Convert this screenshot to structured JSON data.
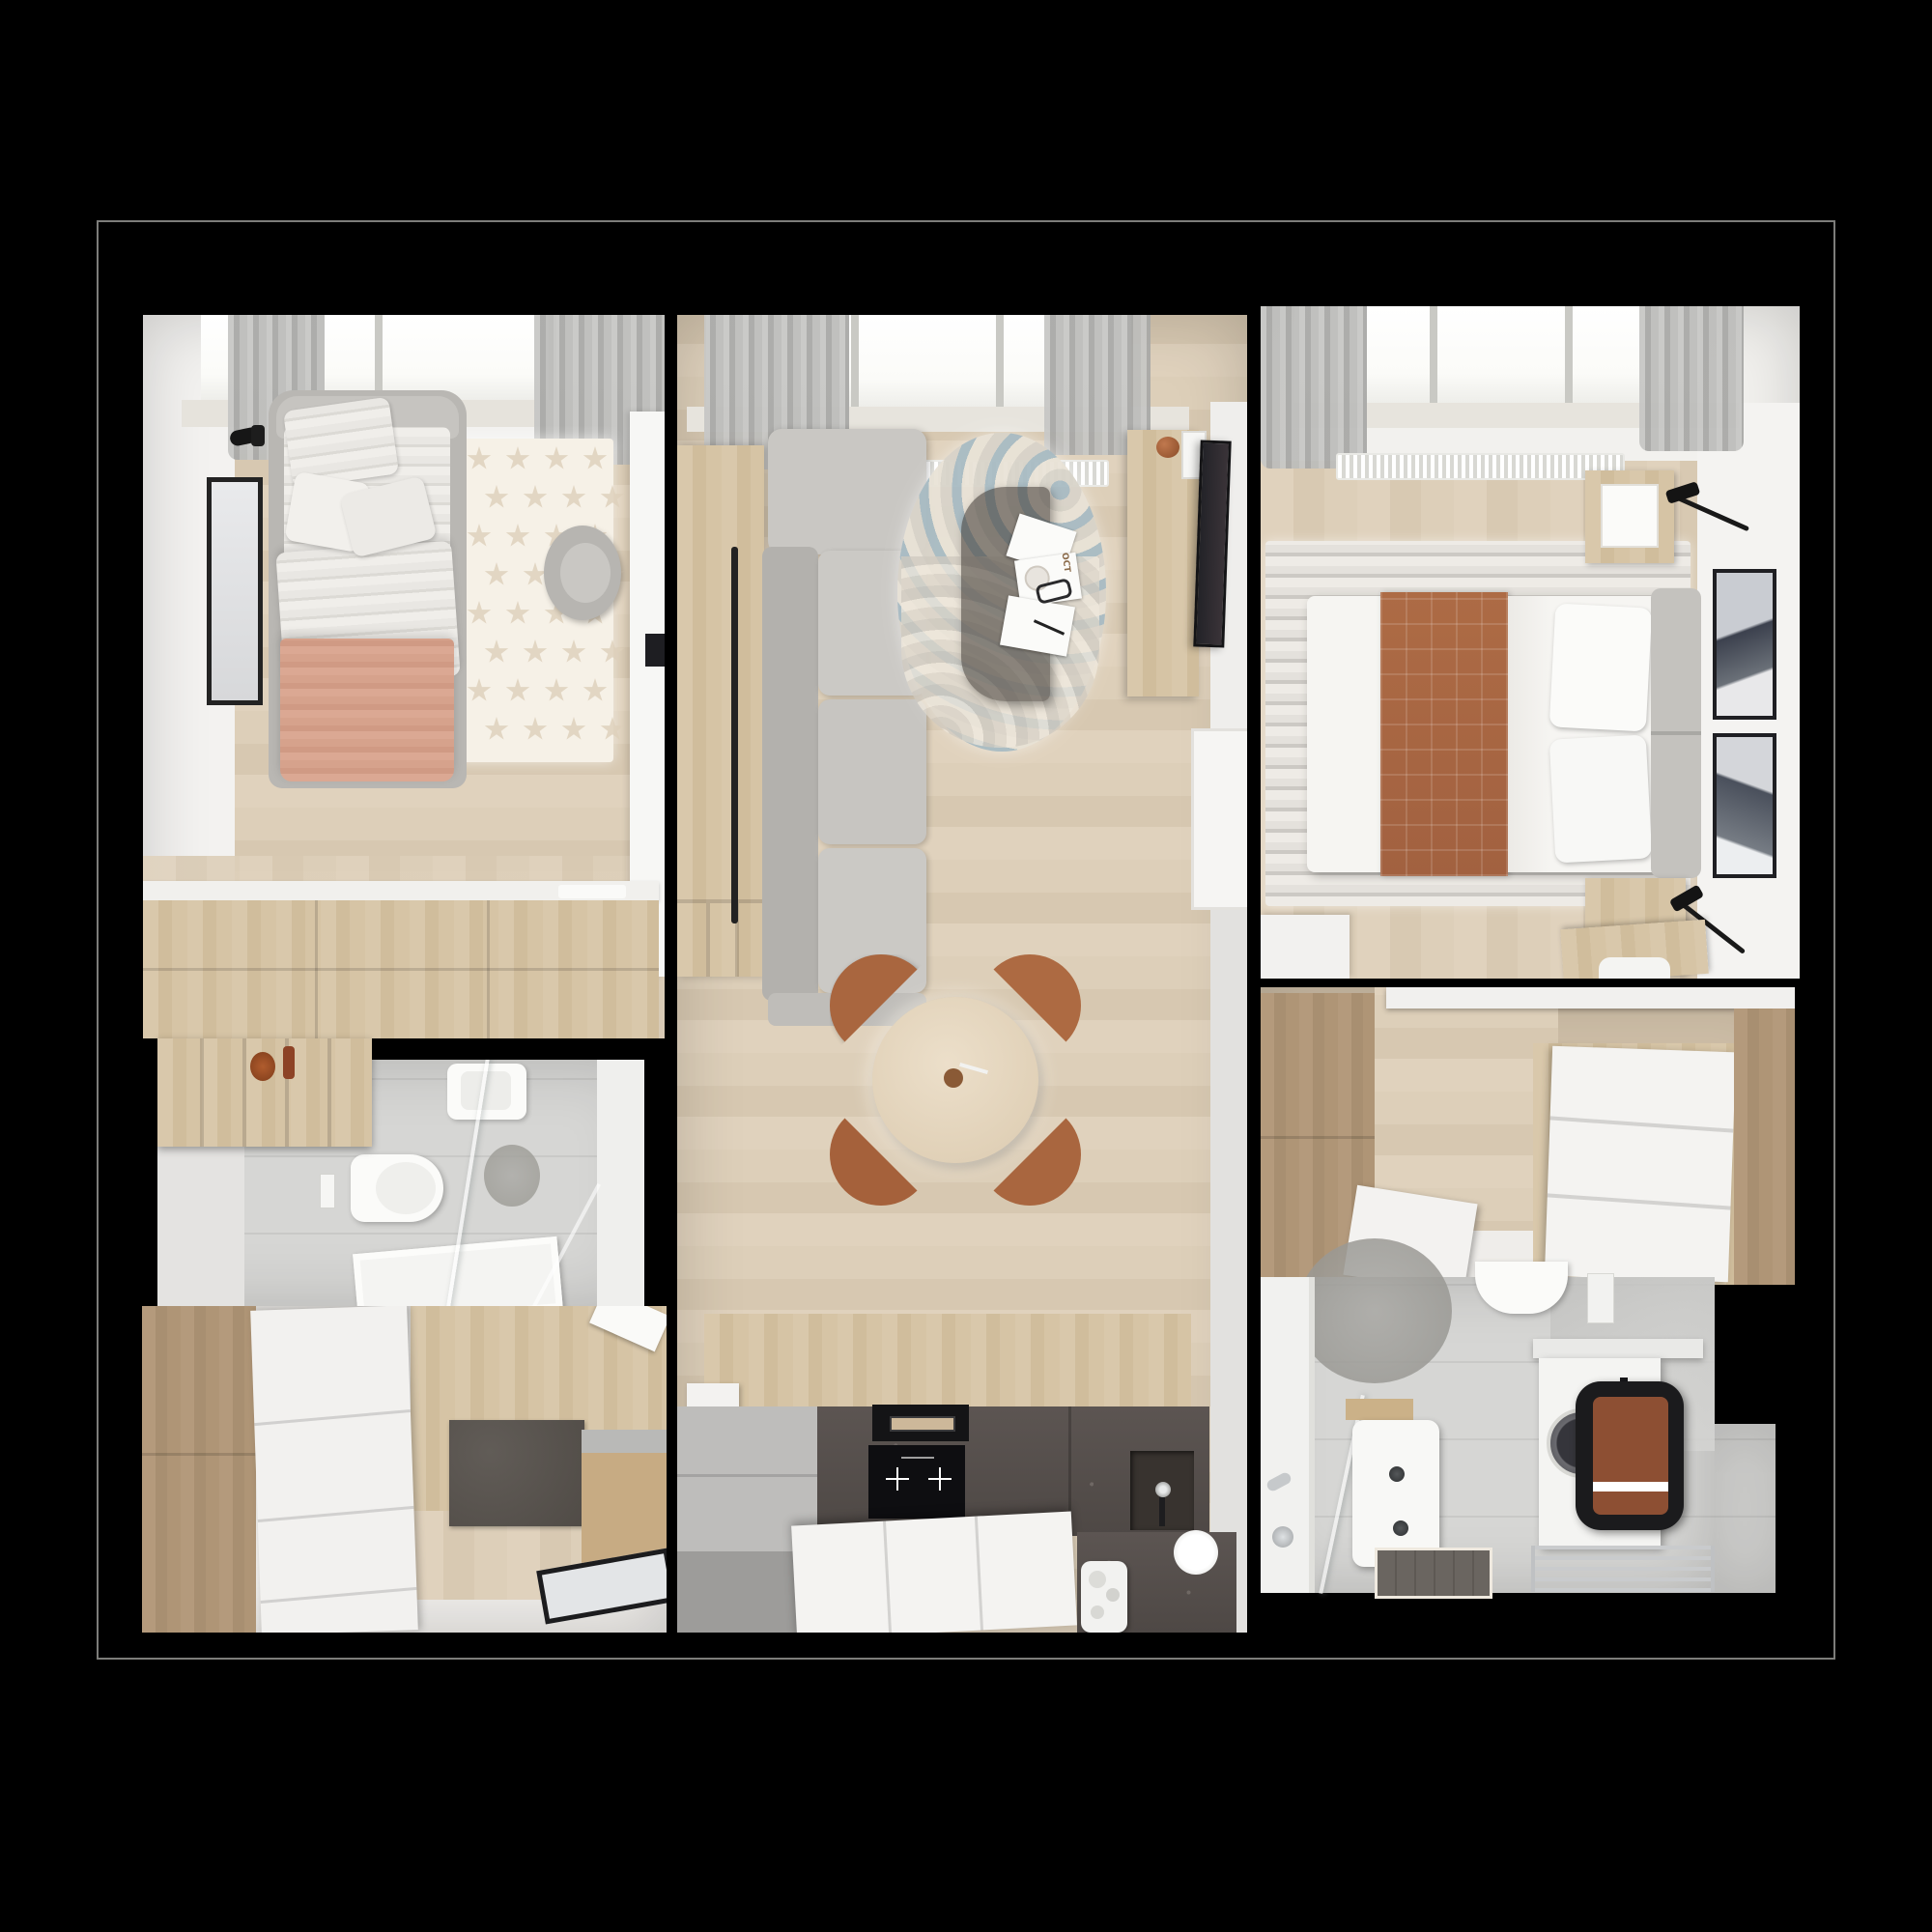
{
  "meta": {
    "scene": "Top-down 3D rendered apartment floor plan on black background",
    "view": "overhead",
    "zones_count": 7
  },
  "labels": {
    "magazine_cover": "OCT"
  },
  "palette": {
    "background": "#000000",
    "outline": "#93938f",
    "wall_white": "#f3f2f0",
    "floor_wood": "#ddcfb9",
    "wood_furniture": "#d2bf9f",
    "wardrobe_brown": "#a88f71",
    "sofa_gray": "#c7c5c1",
    "accent_rust": "#a9663f",
    "blanket_pink": "#d6a28c",
    "granite_dark": "#56504d",
    "appliance_black": "#141416",
    "tile_gray": "#d2d2d0",
    "rug_arc_blue": "#a9bcc4"
  },
  "rooms": [
    {
      "id": "kids-bedroom",
      "position": "top-left",
      "furniture": [
        "single-bed",
        "striped-duvet",
        "pink-blanket",
        "pillows",
        "star-rug",
        "wall-sconce",
        "tall-wall-mirror",
        "desk",
        "desk-chair",
        "laptop",
        "drawer-dresser",
        "window",
        "curtains",
        "radiator"
      ]
    },
    {
      "id": "living-room-kitchen",
      "position": "center",
      "furniture": [
        "sofa",
        "tv-wall-panel",
        "wall-tv",
        "round-arc-rug",
        "glass-coffee-table",
        "magazines",
        "media-console",
        "decor-ball",
        "dining-table",
        "dining-chair-1",
        "dining-chair-2",
        "dining-chair-3",
        "dining-chair-4",
        "kitchen-counter-granite",
        "extractor-hood",
        "induction-hob",
        "kitchen-sink",
        "kitchen-island",
        "plate-stack",
        "coffee-machine",
        "window",
        "curtains",
        "radiator",
        "door-opening"
      ]
    },
    {
      "id": "master-bedroom",
      "position": "top-right",
      "furniture": [
        "double-bed",
        "plaid-throw",
        "pillows",
        "gray-headboard",
        "striped-rug",
        "nightstand-top",
        "nightstand-bottom",
        "swing-arm-lamp-top",
        "swing-arm-lamp-bottom",
        "wall-art-1",
        "wall-art-2",
        "white-dresser",
        "wood-desk",
        "window",
        "curtains",
        "radiator"
      ]
    },
    {
      "id": "bathroom-shower",
      "position": "middle-left",
      "furniture": [
        "open-wood-shelf",
        "decor-bottles",
        "wall-hung-toilet",
        "flush-plate",
        "shower-glass",
        "shower-tray",
        "washbasin",
        "stone-circle-decor"
      ]
    },
    {
      "id": "entry-hall",
      "position": "bottom-left",
      "furniture": [
        "brown-wardrobe",
        "white-wardrobe",
        "doormat",
        "shoe-cabinet",
        "leaning-mirror",
        "paper-sheet"
      ]
    },
    {
      "id": "dressing-hall",
      "position": "middle-right",
      "furniture": [
        "brown-wardrobe",
        "white-chest-of-drawers",
        "open-door-panel",
        "counter-edge"
      ]
    },
    {
      "id": "bathroom-laundry",
      "position": "bottom-right",
      "furniture": [
        "bathtub",
        "bath-faucet",
        "glass-partition",
        "washbasin",
        "dark-floor-mat",
        "toilet",
        "wall-shelf",
        "washing-machine",
        "laundry-bag",
        "rust-towel",
        "towel-rail",
        "stone-circle-decor"
      ]
    }
  ]
}
